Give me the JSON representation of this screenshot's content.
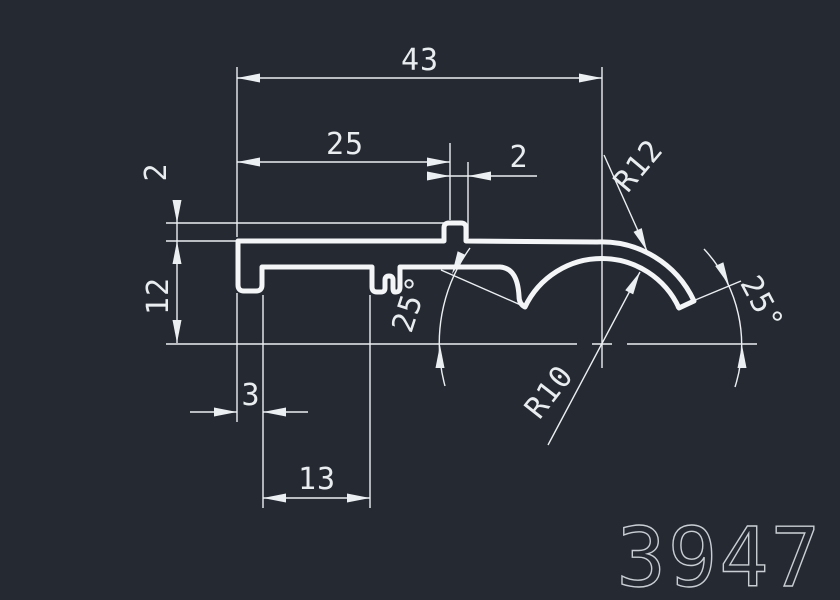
{
  "drawing": {
    "part_number": "3947",
    "colors": {
      "background": "#252932",
      "line": "#ECEFF2"
    },
    "dims": {
      "overall_width": "43",
      "upper_width": "25",
      "tab_width": "2",
      "tab_height": "2",
      "profile_height": "12",
      "foot_width": "3",
      "foot_spacing": "13",
      "outer_radius": "R12",
      "inner_radius": "R10",
      "angle_left": "25°",
      "angle_right": "25°"
    }
  }
}
